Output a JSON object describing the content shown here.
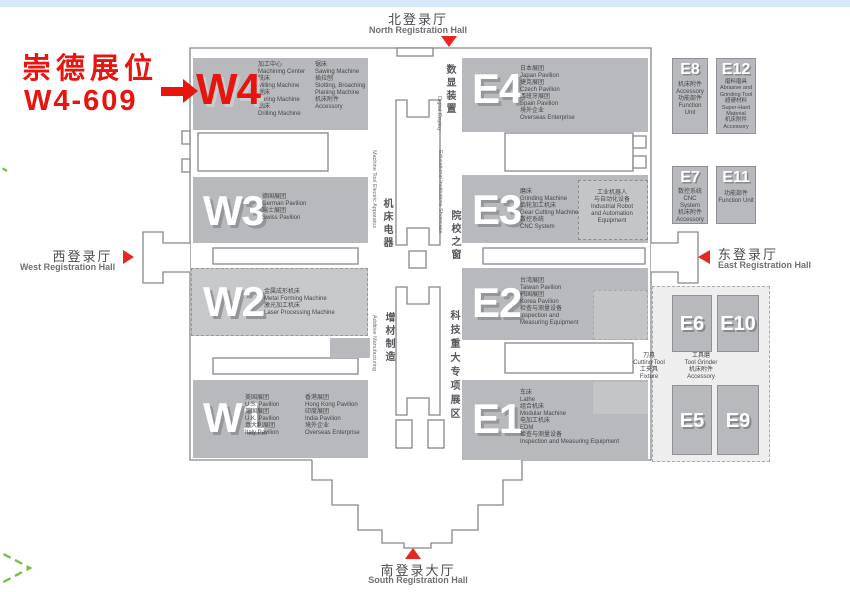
{
  "annotation": {
    "line1": "崇德展位",
    "line2": "W4-609"
  },
  "registration": {
    "north": {
      "zh": "北登录厅",
      "en": "North Registration Hall"
    },
    "south": {
      "zh": "南登录大厅",
      "en": "South Registration Hall"
    },
    "west": {
      "zh": "西登录厅",
      "en": "West Registration Hall"
    },
    "east": {
      "zh": "东登录厅",
      "en": "East Registration Hall"
    }
  },
  "corridors": {
    "machine_tool_electric": {
      "zh": "机床电器",
      "en": "Machine Tool Electric Apparatus"
    },
    "digital_display": {
      "zh": "数显装置",
      "en": "Digital Display"
    },
    "educational": {
      "zh": "院校之窗",
      "en": "Educational Institutions Showcase"
    },
    "additive": {
      "zh": "增材制造",
      "en": "Additive Manufacturing"
    },
    "sci_tech": {
      "zh": "科技重大专项展区"
    }
  },
  "halls": {
    "w4": {
      "code": "W4",
      "col1": [
        "加工中心",
        "Machining Center",
        "铣床",
        "Milling Machine",
        "镗床",
        "Boring Machine",
        "钻床",
        "Drilling Machine"
      ],
      "col2": [
        "锯床",
        "Sawing Machine",
        "插拉刨",
        "Slotting, Broaching",
        "Planing Machine",
        "机床附件",
        "Accessory"
      ]
    },
    "w3": {
      "code": "W3",
      "lines": [
        "德国展团",
        "German Pavilion",
        "瑞士展团",
        "Swiss Pavilion"
      ]
    },
    "w2": {
      "code": "W2",
      "lines": [
        "金属成形机床",
        "Metal Forming Machine",
        "激光加工机床",
        "Laser Processing Machine"
      ]
    },
    "w1": {
      "code": "W1",
      "col1": [
        "美国展团",
        "U.S. Pavilion",
        "英国展团",
        "U.K. Pavilion",
        "意大利展团",
        "Italy Pavilion"
      ],
      "col2": [
        "香港展团",
        "Hong Kong Pavilion",
        "印度展团",
        "India Pavilion",
        "境外企业",
        "Overseas Enterprise"
      ]
    },
    "e4": {
      "code": "E4",
      "lines": [
        "日本展团",
        "Japan Pavilion",
        "捷克展团",
        "Czech Pavilion",
        "西班牙展团",
        "Spain Pavilion",
        "境外企业",
        "Overseas Enterprise"
      ]
    },
    "e3": {
      "code": "E3",
      "lines": [
        "磨床",
        "Grinding Machine",
        "齿轮加工机床",
        "Gear Cutting Machine",
        "数控系统",
        "CNC System"
      ],
      "subzone": [
        "工业机器人",
        "与自动化设备",
        "Industrial Robot",
        "and Automation",
        "Equipment"
      ]
    },
    "e2": {
      "code": "E2",
      "lines": [
        "台湾展团",
        "Taiwan Pavilion",
        "韩国展团",
        "Korea Pavilion",
        "检查与测量设备",
        "Inspection and",
        "Measuring Equipment"
      ]
    },
    "e1": {
      "code": "E1",
      "lines": [
        "车床",
        "Lathe",
        "组合机床",
        "Modular Machine",
        "电加工机床",
        "EDM",
        "检查与测量设备",
        "Inspection and Measuring Equipment"
      ]
    },
    "e8": {
      "code": "E8",
      "lines": [
        "机床附件",
        "Accessory",
        "功能部件",
        "Function Unit"
      ]
    },
    "e12": {
      "code": "E12",
      "lines": [
        "磨料磨具",
        "Abrasive and",
        "Grinding Tool",
        "超硬材料",
        "Super-Hard",
        "Material",
        "机床附件",
        "Accessory"
      ]
    },
    "e7": {
      "code": "E7",
      "lines": [
        "数控系统",
        "CNC System",
        "机床附件",
        "Accessory"
      ]
    },
    "e11": {
      "code": "E11",
      "lines": [
        "功能部件",
        "Function Unit"
      ]
    },
    "e6": {
      "code": "E6"
    },
    "e10": {
      "code": "E10"
    },
    "e5": {
      "code": "E5"
    },
    "e9": {
      "code": "E9"
    },
    "tool_zone": {
      "col1": [
        "刀具",
        "Cutting Tool",
        "工夹具",
        "Fixture"
      ],
      "col2": [
        "工具磨",
        "Tool Grinder",
        "机床附件",
        "Accessory"
      ]
    }
  },
  "colors": {
    "hall_fill": "#b7b9bc",
    "hall_fill_light": "#c6c8ca",
    "outline": "#85878a",
    "highlight_red": "#e8140f",
    "green_dash": "#76c043",
    "top_strip": "#d6e9f6"
  }
}
